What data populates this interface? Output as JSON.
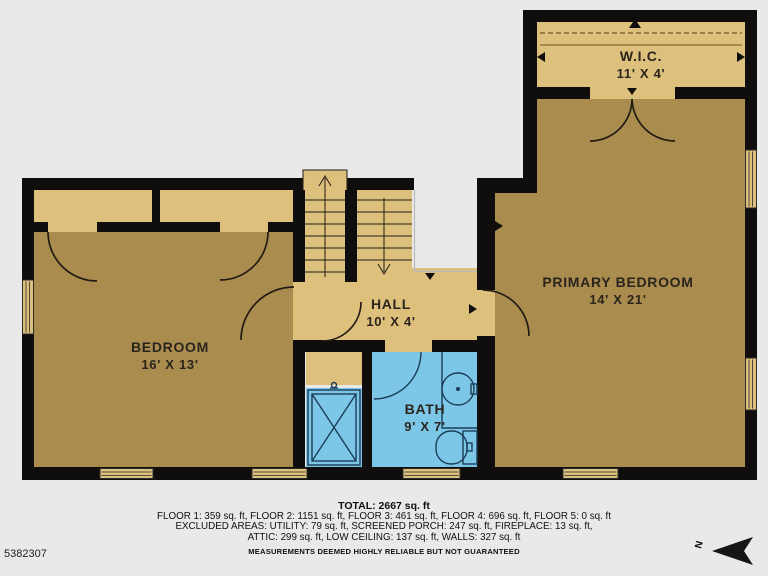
{
  "colors": {
    "background": "#e9e9e9",
    "wall": "#0f0e0c",
    "room_dark_tan": "#a98c4e",
    "room_light_tan": "#dec07d",
    "bath_blue": "#7cc7e8",
    "bath_line": "#1d3d57",
    "line_dark": "#221c14",
    "void_line": "#b9b9b9",
    "label_text": "#2b241c",
    "footer_text": "#101010"
  },
  "rooms": [
    {
      "name": "W.I.C.",
      "dims": "11' X 4'"
    },
    {
      "name": "PRIMARY BEDROOM",
      "dims": "14' X 21'"
    },
    {
      "name": "HALL",
      "dims": "10' X 4'"
    },
    {
      "name": "BEDROOM",
      "dims": "16' X 13'"
    },
    {
      "name": "BATH",
      "dims": "9' X 7'"
    }
  ],
  "footer": {
    "total": "TOTAL: 2667 sq. ft",
    "line1": "FLOOR 1: 359 sq. ft, FLOOR 2: 1151 sq. ft, FLOOR 3: 461 sq. ft, FLOOR 4: 696 sq. ft, FLOOR 5: 0 sq. ft",
    "line2": "EXCLUDED AREAS: UTILITY: 79 sq. ft, SCREENED PORCH: 247 sq. ft, FIREPLACE: 13 sq. ft,",
    "line3": "ATTIC: 299 sq. ft, LOW CEILING: 137 sq. ft, WALLS: 327 sq. ft",
    "disclaimer": "MEASUREMENTS DEEMED HIGHLY RELIABLE BUT NOT GUARANTEED"
  },
  "watermark_id": "5382307",
  "compass": {
    "label": "N"
  }
}
